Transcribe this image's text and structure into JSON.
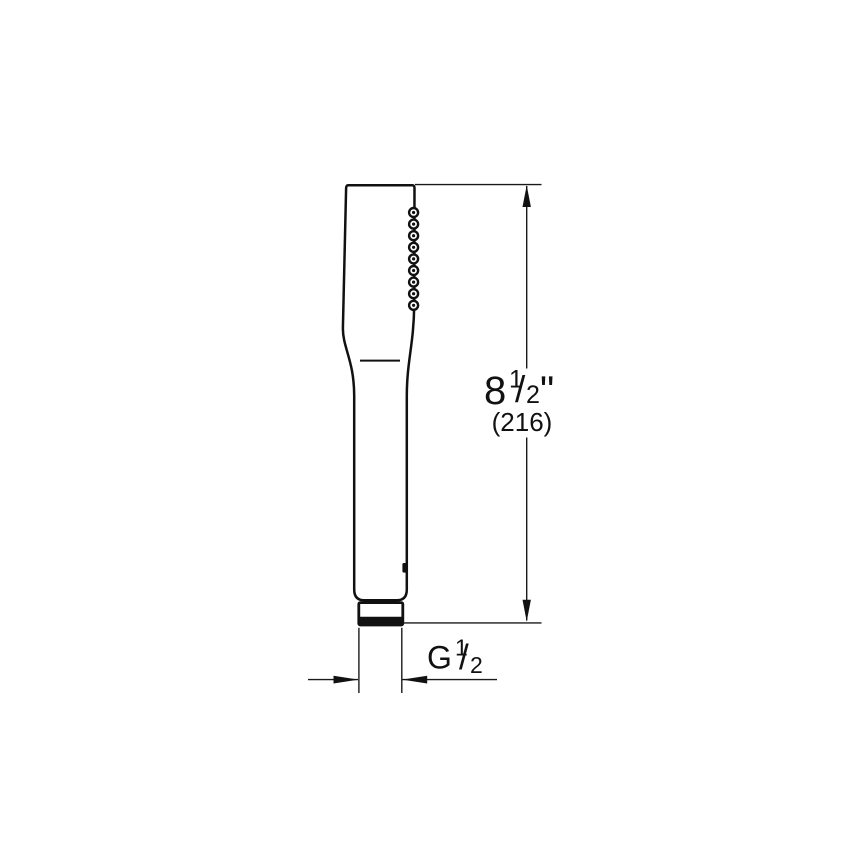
{
  "diagram": {
    "name": "Hand shower technical line drawing with dimensions",
    "line_color": "#111111",
    "background_color": "#ffffff",
    "height_dimension": {
      "whole": "8",
      "numerator": "1",
      "slash": "/",
      "denominator": "2",
      "unit": "\"",
      "metric": "(216)"
    },
    "thread_dimension": {
      "letter": "G",
      "numerator": "1",
      "slash": "/",
      "denominator": "2"
    }
  }
}
